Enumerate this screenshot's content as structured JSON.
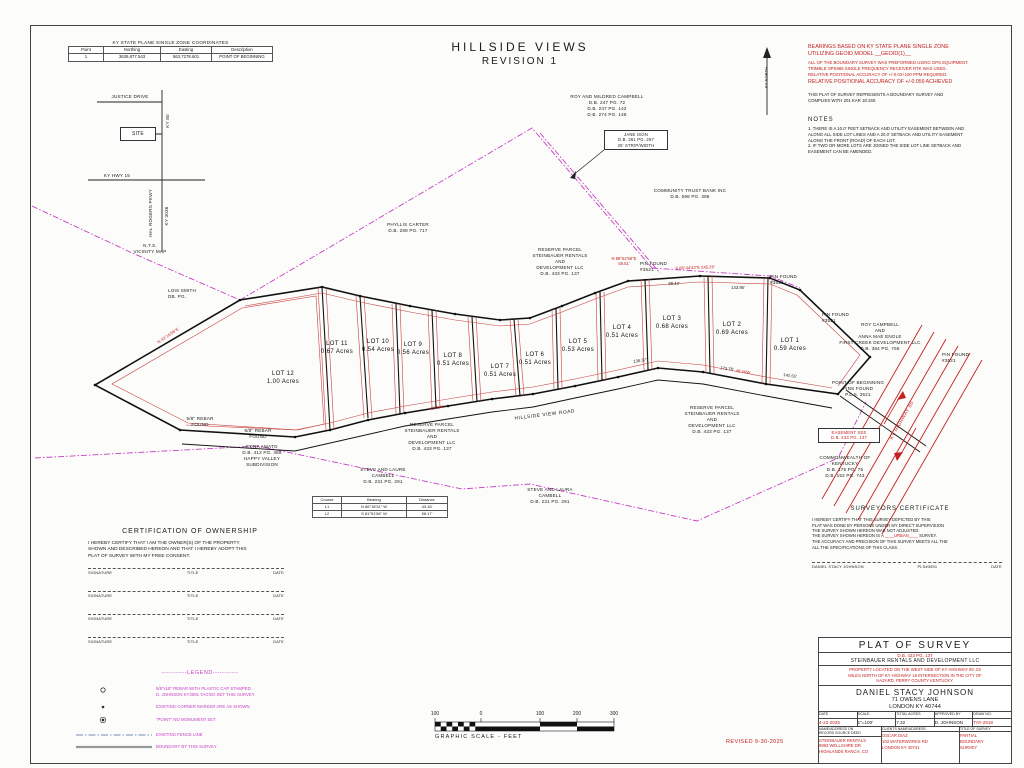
{
  "sheet": {
    "title": "HILLSIDE VIEWS",
    "subtitle": "REVISION 1"
  },
  "coord_table": {
    "title": "KY STATE PLANE SINGLE ZONE COORDINATES",
    "headers": [
      "Point",
      "Northing",
      "Easting",
      "Description"
    ],
    "row": [
      "1",
      "3639,877.543",
      "563,7278.601",
      "POINT OF BEGINNING"
    ]
  },
  "bearing_note": {
    "basis": "BEARINGS BASED ON KY STATE PLANE SINGLE ZONE\nUTILIZING GEOID MODEL __GEOID(1)__",
    "gps": "ALL OF THE BOUNDARY SURVEY WAS PREFORMED USING GPS EQUIPMENT.\nTRIMBLE SPS985 SINGLE FREQUENCY RECEIVER RTK WAS USED.\nRELATIVE POSITIONAL ACCURACY OF +/-0.03+100 PPM REQUIRED.",
    "achieved": "RELATIVE POSITIONAL ACCURACY OF +/-0.059 ACHIEVED",
    "compliance": "THIS PLAT OF SURVEY REPRESENTS A BOUNDARY SURVEY AND\nCOMPLIES WITH 201 KAR 18:150."
  },
  "notes": {
    "title": "NOTES",
    "body": "1. THERE IS A 10.0' FEET SETBACK AND UTILITY EASEMENT BETWEEN AND\nALONG ALL SIDE LOT LINES AND A 20.0' SETBACK AND UTILITY EASEMENT\nALONG THE FRONT (ROAD) OF EACH LOT.\n2. IF TWO OR MORE LOTS ARE JOINED THE SIDE LOT LINE SETBACK AND\nEASEMENT CAN BE AMENDED."
  },
  "north_label": "KY NORTH",
  "vicinity": {
    "justice": "JUSTICE DRIVE",
    "ky80": "KY 80",
    "site": "SITE",
    "hwy15": "KY HWY 15",
    "pkwy": "HAL ROGERS PKWY",
    "ky3036": "KY 3036",
    "caption": "N.T.S.\nVICINITY MAP"
  },
  "lots": [
    {
      "label": "LOT 1\n0.59 Acres"
    },
    {
      "label": "LOT 2\n0.69 Acres"
    },
    {
      "label": "LOT 3\n0.68 Acres"
    },
    {
      "label": "LOT 4\n0.51 Acres"
    },
    {
      "label": "LOT 5\n0.53 Acres"
    },
    {
      "label": "LOT 6\n0.51 Acres"
    },
    {
      "label": "LOT 7\n0.51 Acres"
    },
    {
      "label": "LOT 8\n0.51 Acres"
    },
    {
      "label": "LOT 9\n0.56 Acres"
    },
    {
      "label": "LOT 10\n0.54 Acres"
    },
    {
      "label": "LOT 11\n0.67 Acres"
    },
    {
      "label": "LOT 12\n1.00 Acres"
    }
  ],
  "labels": {
    "lois_smith": "LOIS SMITH\nDB.   PG.",
    "phyllis": "PHYLLIS CARTER\nD.B. 288 PG. 717",
    "roy_mildred": "ROY AND MILDRED CAMPBELL\nD.B. 247 PG. 72\nD.B. 247 PG. 142\nD.B. 274 PG. 148",
    "jane_ison": "JANE ISON\nD.B. 361 PG. 267\n25' STRIP/WIDTH",
    "community": "COMMUNITY TRUST BANK INC\nD.B. 598 PG. 386",
    "reserve": "RESERVE PARCEL\nSTEINBAUER RENTALS\nAND\nDEVELOPMENT LLC\nD.B. 433 PG. 137",
    "edna": "EDNA AMATO\nD.B. 412 PG. 469\nHAPPY VALLEY\nSUBDIVISION",
    "rebar": "5/8\" REBAR\nFOUND",
    "steve_laure": "STEVE AND LAURE\nCAMBELL\nD.B. 231 PG. 291",
    "steve_laura": "STEVE AND LAURA\nCAMBELL\nD.B. 231 PG. 291",
    "roy_campbell": "ROY CAMPBELL\nAND\nANNA MAE ENGLE\nFIRST CREEK DEVELOPMENT LLC\nD.B. 384 PG. 756",
    "commonwealth": "COMMONWEALTH OF\nKENTUCKY\nD.B. 175 PG. 75\nD.B. 152 PG. 743",
    "pob": "POINT OF BEGINNING\nPINS FOUND\nP.L.S. 3521",
    "pin_found": "PIN FOUND\n#3521",
    "easement": "EASEMENT SEE\nD.B. 433 PG. 137",
    "road": "HILLSIDE VIEW ROAD",
    "highway": "KY HIGHWAY 80"
  },
  "bearing_labels": [
    {
      "text": "N 88°52'56\"E\n58.51'"
    },
    {
      "text": "S 86°44'43\"E  245.29'"
    },
    {
      "text": "96.44'"
    },
    {
      "text": "143.95'"
    },
    {
      "text": "136.37'"
    },
    {
      "text": "173.76'"
    },
    {
      "text": "142.55'"
    },
    {
      "text": "40' R/W"
    },
    {
      "text": "40' R/W"
    },
    {
      "text": "N 43°16'55\"E"
    }
  ],
  "course_table": {
    "headers": [
      "Course",
      "Bearing",
      "Distance"
    ],
    "rows": [
      [
        "L1",
        "N 86°18'31\" W",
        "43.16'"
      ],
      [
        "L2",
        "S 81°51'56\" W",
        "58.17'"
      ]
    ]
  },
  "ownership_cert": {
    "title": "CERTIFICATION OF OWNERSHIP",
    "body": "I HEREBY CERTIFY THAT I AM THE OWNER(S) OF THE PROPERTY\nSHOWN AND DESCRIBED HEREON AND THAT I HEREBY ADOPT THIS\nPLAT OF SURVEY WITH MY FREE CONSENT.",
    "sig": "SIGNATURE",
    "title_col": "TITLE",
    "date": "DATE"
  },
  "surveyor_cert": {
    "title": "SURVEYORS CERTIFICATE",
    "body1": "I HEREBY CERTIFY THAT THIS SURVEY DEPICTED BY THIS\nPLAT WAS DONE BY PERSONS UNDER MY DIRECT SUPERVISION\nTHE SURVEY SHOWN HEREON WAS NOT ADJUSTED.",
    "is_a": "THE SURVEY SHOWN HEREON IS A ",
    "urban": "____URBAN____",
    "survey_word": " SURVEY.",
    "body2": "THE ACCURACY AND PRECISION OF THIS SURVEY MEETS ALL THE\nALL THE SPECIFICATIONS OF THIS CLASS.",
    "sig_name": "DANIEL STACY JOHNSON",
    "sig_pls": "PLS#3591",
    "sig_date": "DATE"
  },
  "legend": {
    "title": "-----------LEGEND-----------",
    "items": [
      {
        "text": "5/8\"x18\" REBAR WITH PLASTIC CAP STAMPED\nD. JOHNSON KY3591 TAG'ED SET THIS SURVEY."
      },
      {
        "text": "EXISTING CORNER MARKER ARE AS SHOWN"
      },
      {
        "text": "\"POINT\" NO MONUMENT SET"
      },
      {
        "text": "EXISTING FENCE LINE"
      },
      {
        "text": "BOUNDARY BY THIS SURVEY"
      }
    ]
  },
  "scale_bar": {
    "ticks": [
      "100",
      "0",
      "100",
      "200",
      "300"
    ],
    "caption": "GRAPHIC SCALE - FEET"
  },
  "revised": "REVISED 9-30-2025",
  "title_block": {
    "title": "PLAT OF SURVEY",
    "db": "D.B. 433 PG. 137",
    "company": "STEINBAUER RENTALS AND DEVELOPMENT LLC",
    "location": "PROPERTY LOCATED ON THE WEST SIDE OF KY HIGHWAY 80 .03\nMILES NORTH OF KY HIGHWAY 15 INTERSECTION IN THE CITY OF\nHAZARD, PERRY COUNTY KENTUCKY.",
    "surveyor": "DANIEL STACY JOHNSON",
    "address1": "71 OWENS LANE",
    "address2": "LONDON KY 40744",
    "row1_headers": [
      "DATE",
      "SCALE",
      "TOTAL ACRES",
      "APPROVED BY",
      "DRAW NO."
    ],
    "row1_values": [
      "4-22-2025",
      "1\"=100'",
      "7.32",
      "D. JOHNSON",
      "TAY-2918"
    ],
    "row2_headers": [
      "NAME/ADDRESS ON\nRECORD SOURCE DEED",
      "CLIENTS NAME/ADDRESS",
      "TITLE OF SURVEY"
    ],
    "row2_values": [
      "STEINBAUER RENTALS\n9993 WELLSHIRE DR\nHIGHLANDS RANCH, CO",
      "OSCAR DIAZ\n103 WATERWORKS RD\nLONDON KY 40741",
      "PARTIAL\nBOUNDARY\nSURVEY"
    ]
  }
}
